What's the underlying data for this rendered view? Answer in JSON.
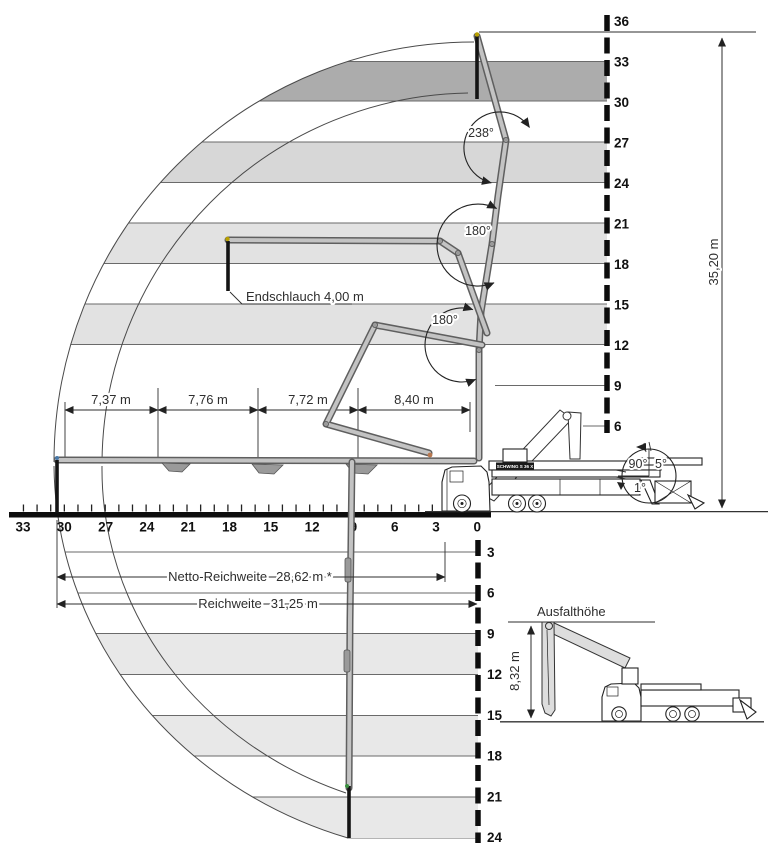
{
  "colors": {
    "band_dark": "#acacac",
    "band_mid": "#d7d7d7",
    "band_light": "#e2e2e2",
    "band_lower": "#e8e8e8"
  },
  "axes": {
    "upper_vertical": [
      "36",
      "33",
      "30",
      "27",
      "24",
      "21",
      "18",
      "15",
      "12",
      "9",
      "6"
    ],
    "lower_vertical": [
      "3",
      "6",
      "9",
      "12",
      "15",
      "18",
      "21",
      "24"
    ],
    "horizontal": [
      "33",
      "30",
      "27",
      "24",
      "21",
      "18",
      "15",
      "12",
      "9",
      "6",
      "3",
      "0"
    ]
  },
  "boom_sections": [
    "7,37 m",
    "7,76 m",
    "7,72 m",
    "8,40 m"
  ],
  "reach": {
    "height": "35,20 m",
    "net_label": "Netto-Reichweite",
    "net_value": "28,62 m *",
    "gross_label": "Reichweite",
    "gross_value": "31,25 m"
  },
  "end_hose_label": "Endschlauch 4,00 m",
  "angles": {
    "joint1": "238°",
    "joint2": "180°",
    "joint3": "180°",
    "slew_90": "90°",
    "slew_5": "5°",
    "slew_1": "1°"
  },
  "inset": {
    "title": "Ausfalthöhe",
    "height": "8,32 m"
  },
  "truck_badge": "SCHWING S 36 X"
}
